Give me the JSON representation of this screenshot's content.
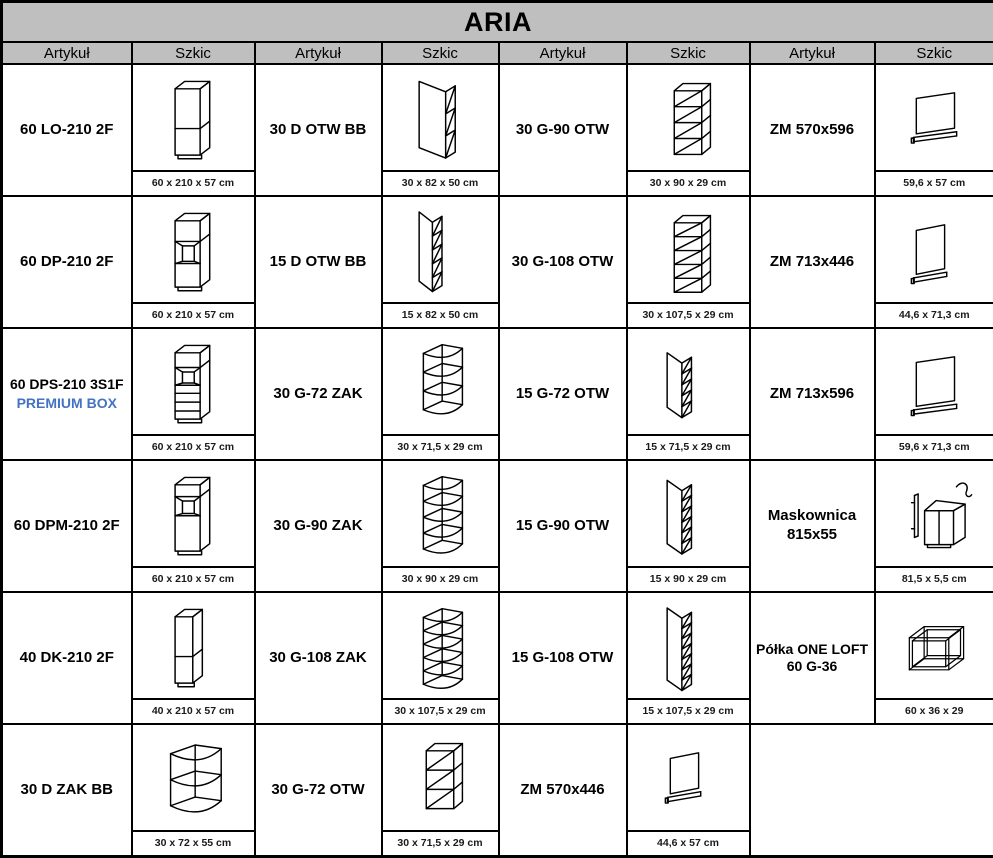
{
  "title": "ARIA",
  "header": {
    "artykul": "Artykuł",
    "szkic": "Szkic"
  },
  "colors": {
    "header_bg": "#bfbfbf",
    "accent_blue": "#4472c4",
    "border": "#000000"
  },
  "rows": [
    [
      {
        "article": "60 LO-210 2F",
        "dims": "60 x 210 x 57 cm",
        "sketch": "tall-cabinet-2door"
      },
      {
        "article": "30 D OTW BB",
        "dims": "30 x 82 x 50 cm",
        "sketch": "base-open-shelf-wide"
      },
      {
        "article": "30 G-90 OTW",
        "dims": "30 x 90 x 29 cm",
        "sketch": "wall-shelf-front-4"
      },
      {
        "article": "ZM 570x596",
        "dims": "59,6 x 57 cm",
        "sketch": "panel-570x596"
      }
    ],
    [
      {
        "article": "60 DP-210 2F",
        "dims": "60 x 210 x 57 cm",
        "sketch": "tall-cabinet-oven"
      },
      {
        "article": "15 D OTW BB",
        "dims": "15 x 82 x 50 cm",
        "sketch": "base-open-shelf-narrow"
      },
      {
        "article": "30 G-108 OTW",
        "dims": "30 x 107,5 x 29 cm",
        "sketch": "wall-shelf-front-5"
      },
      {
        "article": "ZM 713x446",
        "dims": "44,6 x 71,3 cm",
        "sketch": "panel-713x446"
      }
    ],
    [
      {
        "article": "60 DPS-210 3S1F",
        "note": "PREMIUM BOX",
        "dims": "60 x 210 x 57 cm",
        "sketch": "tall-cabinet-oven-drawers"
      },
      {
        "article": "30 G-72 ZAK",
        "dims": "30 x 71,5 x 29 cm",
        "sketch": "corner-shelf-4"
      },
      {
        "article": "15 G-72 OTW",
        "dims": "15 x 71,5 x 29 cm",
        "sketch": "wall-shelf-side-5"
      },
      {
        "article": "ZM 713x596",
        "dims": "59,6 x 71,3 cm",
        "sketch": "panel-713x596"
      }
    ],
    [
      {
        "article": "60 DPM-210 2F",
        "dims": "60 x 210 x 57 cm",
        "sketch": "tall-cabinet-microwave"
      },
      {
        "article": "30 G-90 ZAK",
        "dims": "30 x 90 x 29 cm",
        "sketch": "corner-shelf-5"
      },
      {
        "article": "15 G-90 OTW",
        "dims": "15 x 90 x 29 cm",
        "sketch": "wall-shelf-side-6"
      },
      {
        "article": "Maskownica",
        "article2": "815x55",
        "dims": "81,5 x 5,5 cm",
        "sketch": "cornice-strip"
      }
    ],
    [
      {
        "article": "40 DK-210 2F",
        "dims": "40 x 210 x 57 cm",
        "sketch": "tall-cabinet-2door-narrow"
      },
      {
        "article": "30 G-108 ZAK",
        "dims": "30 x 107,5 x 29 cm",
        "sketch": "corner-shelf-6"
      },
      {
        "article": "15 G-108 OTW",
        "dims": "15 x 107,5 x 29 cm",
        "sketch": "wall-shelf-side-7"
      },
      {
        "article": "Półka ONE LOFT",
        "article2": "60 G-36",
        "dims": "60 x 36 x 29",
        "sketch": "open-frame-shelf"
      }
    ],
    [
      {
        "article": "30 D ZAK BB",
        "dims": "30 x 72 x 55 cm",
        "sketch": "corner-base-shelf-3"
      },
      {
        "article": "30 G-72 OTW",
        "dims": "30 x 71,5 x 29 cm",
        "sketch": "wall-shelf-front-3"
      },
      {
        "article": "ZM 570x446",
        "dims": "44,6 x 57 cm",
        "sketch": "panel-570x446"
      },
      null
    ]
  ]
}
